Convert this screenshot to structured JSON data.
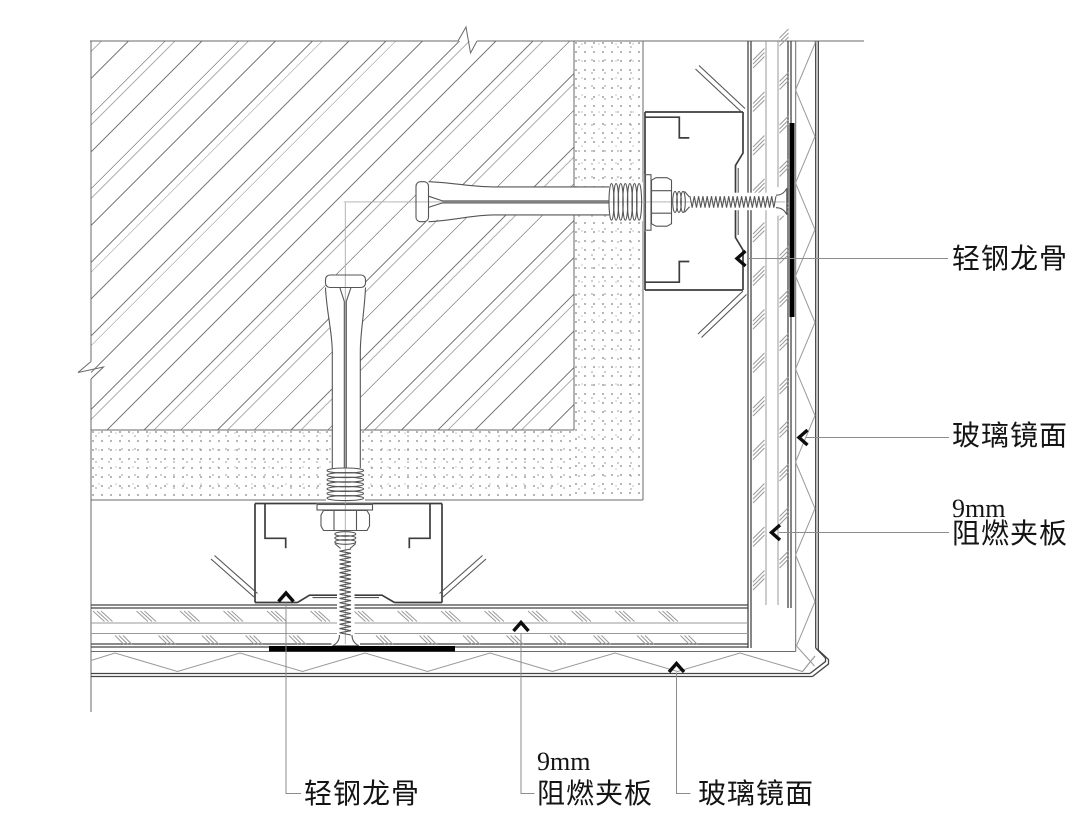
{
  "drawing": {
    "background": "#ffffff",
    "line_color": "#555555",
    "accent_black": "#000000"
  },
  "callouts": {
    "right_keel": "轻钢龙骨",
    "right_mirror": "玻璃镜面",
    "right_plywood_size": "9mm",
    "right_plywood": "阻燃夹板",
    "bottom_keel": "轻钢龙骨",
    "bottom_plywood_size": "9mm",
    "bottom_plywood": "阻燃夹板",
    "bottom_mirror": "玻璃镜面"
  }
}
